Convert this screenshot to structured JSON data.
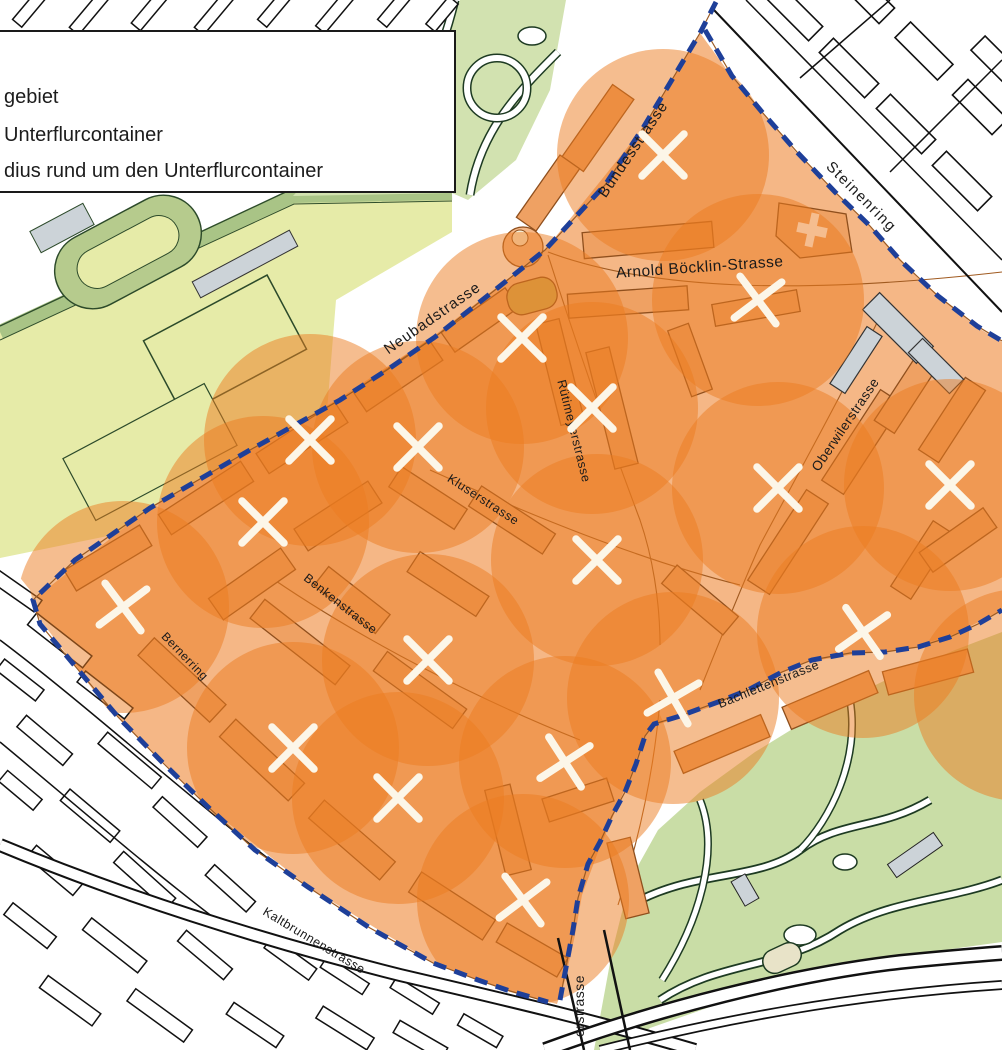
{
  "legend": {
    "items": [
      {
        "label": "gebiet"
      },
      {
        "label": "Unterflurcontainer"
      },
      {
        "label": "dius rund um den Unterflurcontainer"
      }
    ]
  },
  "map": {
    "streets": [
      {
        "name": "bundesstrasse",
        "text": "Bundesstrasse",
        "x": 637,
        "y": 152,
        "rot": -56,
        "size": 15,
        "ls": 1
      },
      {
        "name": "steinenring",
        "text": "Steinenring",
        "x": 858,
        "y": 200,
        "rot": 45,
        "size": 15,
        "ls": 1.5
      },
      {
        "name": "arnold-boecklin-strasse",
        "text": "Arnold Böcklin-Strasse",
        "x": 700,
        "y": 272,
        "rot": -4,
        "size": 15.5,
        "ls": 0.5
      },
      {
        "name": "neubadstrasse",
        "text": "Neubadstrasse",
        "x": 435,
        "y": 322,
        "rot": -35,
        "size": 15,
        "ls": 1
      },
      {
        "name": "ruetimeyerstrasse",
        "text": "Rütimeyerstrasse",
        "x": 570,
        "y": 432,
        "rot": 76,
        "size": 12.5,
        "ls": 0.5
      },
      {
        "name": "oberwilerstrasse",
        "text": "Oberwilerstrasse",
        "x": 849,
        "y": 427,
        "rot": -56,
        "size": 13.5,
        "ls": 0.5
      },
      {
        "name": "kluserstrasse",
        "text": "Kluserstrasse",
        "x": 481,
        "y": 503,
        "rot": 33,
        "size": 12.5,
        "ls": 0.5
      },
      {
        "name": "benkenstrasse",
        "text": "Benkenstrasse",
        "x": 338,
        "y": 607,
        "rot": 38,
        "size": 12.5,
        "ls": 0.5
      },
      {
        "name": "bernerring",
        "text": "Bernerring",
        "x": 182,
        "y": 659,
        "rot": 46,
        "size": 12,
        "ls": 0.5
      },
      {
        "name": "bachlettenstrasse",
        "text": "Bachlettenstrasse",
        "x": 770,
        "y": 688,
        "rot": -22,
        "size": 12.5,
        "ls": 0.5
      },
      {
        "name": "kaltbrunnenstrasse",
        "text": "Kaltbrunnenstrasse",
        "x": 312,
        "y": 944,
        "rot": 31,
        "size": 12.5,
        "ls": 0.5
      },
      {
        "name": "erstrasse-partial",
        "text": "erstrasse",
        "x": 584,
        "y": 1006,
        "rot": -90,
        "size": 14,
        "ls": 0.5
      }
    ],
    "containers": [
      [
        663,
        155,
        0
      ],
      [
        758,
        300,
        8
      ],
      [
        522,
        338,
        0
      ],
      [
        592,
        408,
        0
      ],
      [
        310,
        440,
        0
      ],
      [
        418,
        447,
        0
      ],
      [
        263,
        522,
        0
      ],
      [
        123,
        607,
        8
      ],
      [
        293,
        748,
        0
      ],
      [
        398,
        798,
        0
      ],
      [
        565,
        762,
        12
      ],
      [
        523,
        900,
        8
      ],
      [
        673,
        698,
        15
      ],
      [
        863,
        632,
        10
      ],
      [
        778,
        488,
        0
      ],
      [
        950,
        485,
        0
      ],
      [
        597,
        560,
        0
      ],
      [
        428,
        660,
        0
      ]
    ],
    "offscreen_circles": [
      [
        1020,
        695,
        0
      ]
    ],
    "radius": 106,
    "colors": {
      "circle": "#ec7c1f",
      "boundary": "#1e3f99",
      "pilot_area": "#f5b786",
      "building": "#efa163",
      "building_outline": "#8f4f1d",
      "park": "#d2e2b0",
      "field": "#e6eba8",
      "zoo": "#c9dda6",
      "gray_building": "#ccd3d8",
      "marker": "#fcf6e8"
    }
  }
}
